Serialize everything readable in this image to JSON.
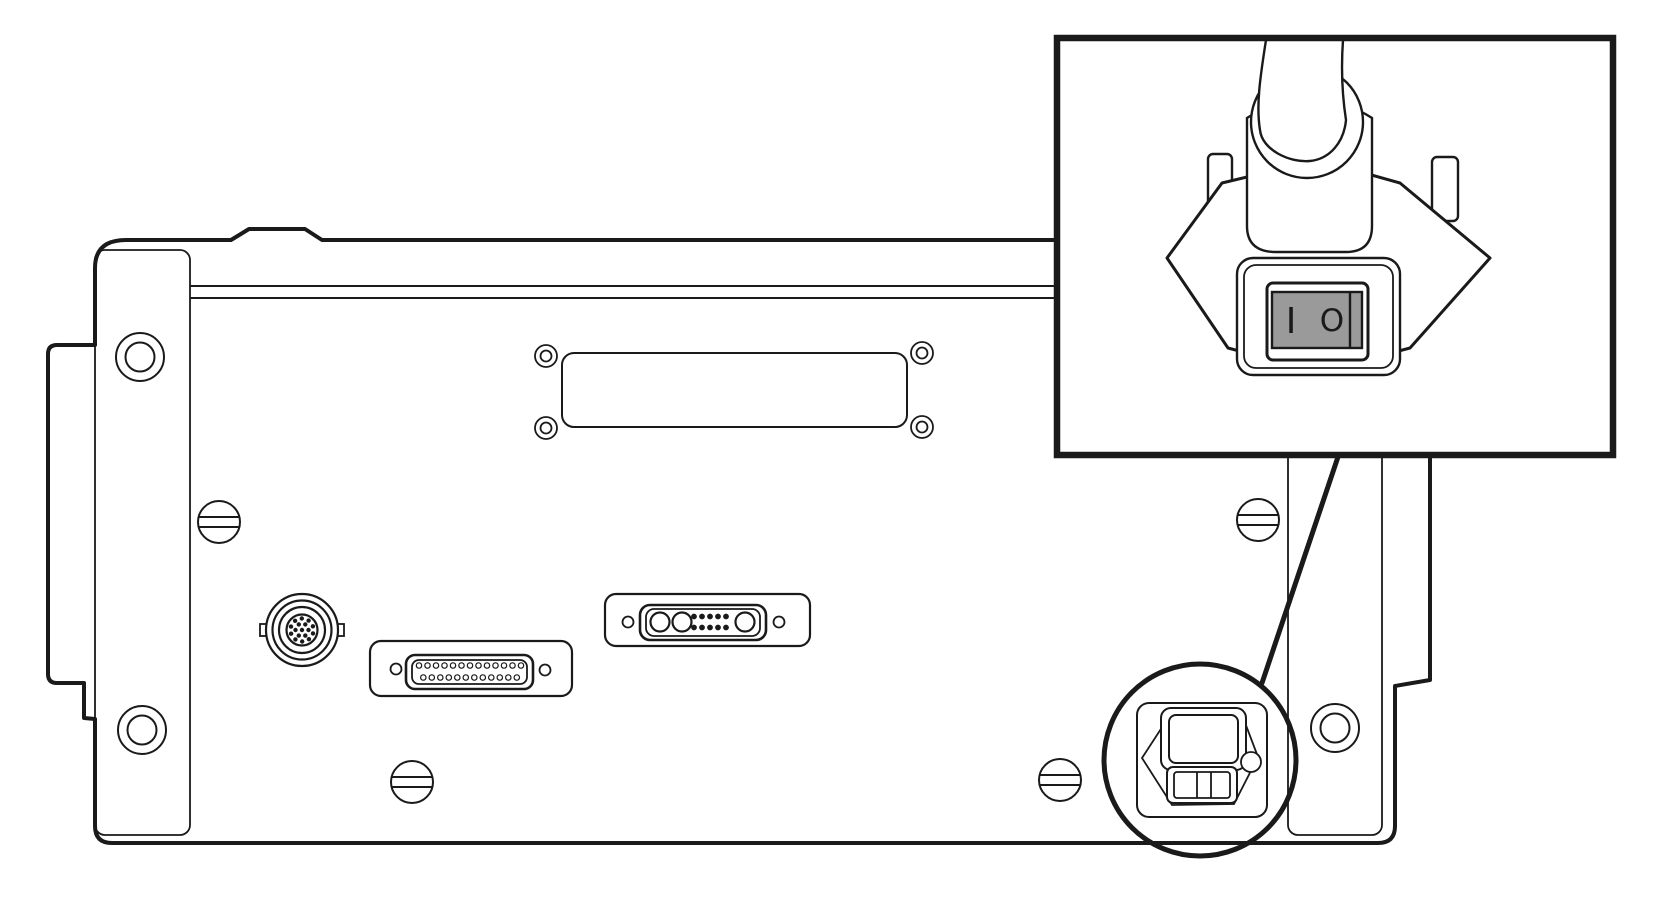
{
  "figure": {
    "title": "Rear-panel technical line drawing with power switch callout",
    "kind": "technical illustration",
    "background_color": "#ffffff",
    "line_color": "#1a1a1a"
  },
  "inset": {
    "description": "Close-up of detachable power-cord plug with built-in rocker power switch",
    "switch": {
      "on_label": "I",
      "off_label": "O",
      "rocker_fill": "#9a9a9a"
    }
  },
  "panel": {
    "components": [
      "left-mounting-bracket",
      "right-mounting-bracket",
      "blank-cover-plate",
      "circular-din-connector",
      "db25-connector",
      "combo-dsub-connector",
      "slotted-panel-screws",
      "power-inlet-module",
      "fuse-drawer",
      "callout-circle"
    ]
  }
}
